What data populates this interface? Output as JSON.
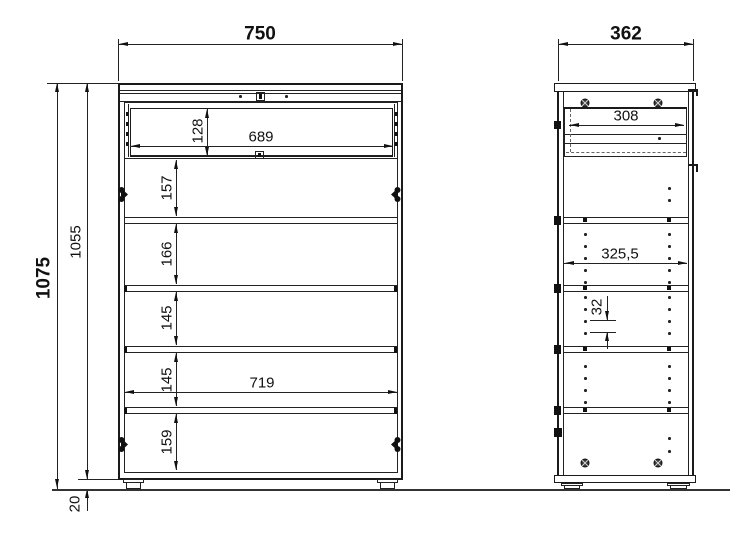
{
  "front": {
    "total_width": "750",
    "drawer_inner_width": "689",
    "drawer_front_height": "128",
    "inner_width": "719",
    "total_height": "1075",
    "body_height": "1055",
    "plinth_height": "20",
    "compartment_heights": [
      "157",
      "166",
      "145",
      "145",
      "159"
    ]
  },
  "side": {
    "total_depth": "362",
    "drawer_depth": "308",
    "inner_depth": "325,5",
    "hole_pitch": "32"
  },
  "colors": {
    "line": "#1a1a1a",
    "background": "#ffffff"
  }
}
